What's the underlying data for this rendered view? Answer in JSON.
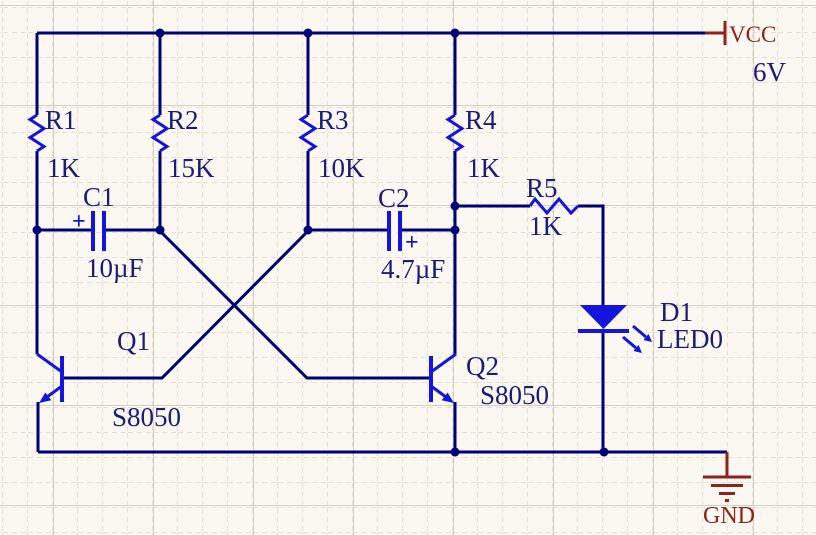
{
  "power": {
    "vcc_label": "VCC",
    "vcc_voltage": "6V",
    "gnd_label": "GND"
  },
  "components": {
    "R1": {
      "ref": "R1",
      "value": "1K"
    },
    "R2": {
      "ref": "R2",
      "value": "15K"
    },
    "R3": {
      "ref": "R3",
      "value": "10K"
    },
    "R4": {
      "ref": "R4",
      "value": "1K"
    },
    "R5": {
      "ref": "R5",
      "value": "1K"
    },
    "C1": {
      "ref": "C1",
      "value": "10µF",
      "polarity_mark": "+"
    },
    "C2": {
      "ref": "C2",
      "value": "4.7µF",
      "polarity_mark": "+"
    },
    "Q1": {
      "ref": "Q1",
      "value": "S8050"
    },
    "Q2": {
      "ref": "Q2",
      "value": "S8050"
    },
    "D1": {
      "ref": "D1",
      "value": "LED0"
    }
  },
  "colors": {
    "wire": "#000078",
    "symbol_blue": "#1414DC",
    "label_text": "#1C1C78",
    "power_red": "#8E231B",
    "background": "#FAF8F1",
    "grid_minor": "#E4E1D6",
    "grid_major": "#D2CFC4"
  }
}
